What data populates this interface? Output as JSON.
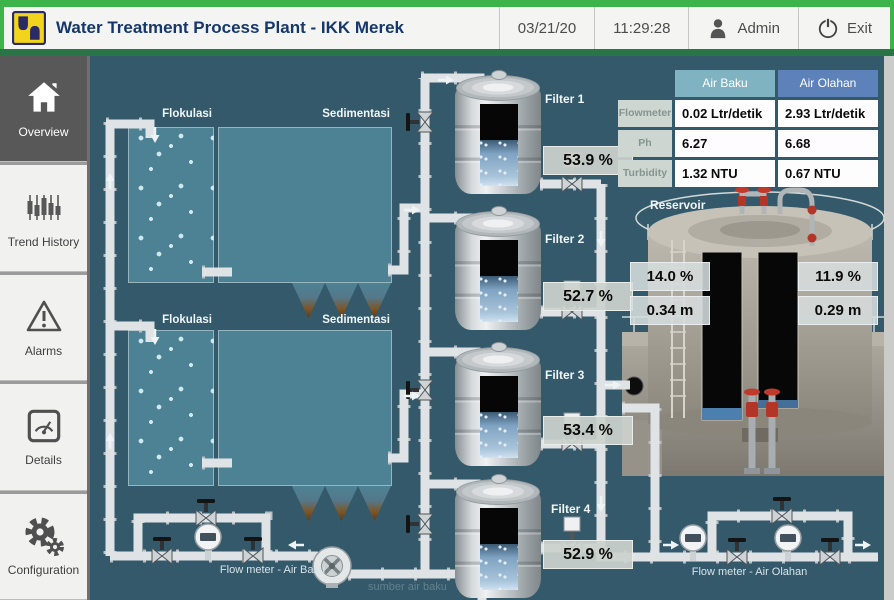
{
  "header": {
    "title": "Water Treatment Process Plant - IKK Merek",
    "date": "03/21/20",
    "time": "11:29:28",
    "user": "Admin",
    "exit_label": "Exit"
  },
  "sidebar": {
    "items": [
      {
        "label": "Overview",
        "active": true
      },
      {
        "label": "Trend History",
        "active": false
      },
      {
        "label": "Alarms",
        "active": false
      },
      {
        "label": "Details",
        "active": false
      },
      {
        "label": "Configuration",
        "active": false
      }
    ]
  },
  "process": {
    "trains": [
      {
        "flocculation_label": "Flokulasi",
        "sedimentation_label": "Sedimentasi"
      },
      {
        "flocculation_label": "Flokulasi",
        "sedimentation_label": "Sedimentasi"
      }
    ],
    "filters": [
      {
        "label": "Filter 1",
        "level": "53.9 %"
      },
      {
        "label": "Filter 2",
        "level": "52.7 %"
      },
      {
        "label": "Filter 3",
        "level": "53.4 %"
      },
      {
        "label": "Filter 4",
        "level": "52.9 %"
      }
    ],
    "reservoir": {
      "label": "Reservoir",
      "left": {
        "percent": "14.0 %",
        "level": "0.34 m"
      },
      "right": {
        "percent": "11.9 %",
        "level": "0.29 m"
      }
    },
    "flow_meter_raw_label": "Flow meter - Air Baku",
    "flow_meter_treated_label": "Flow meter - Air Olahan",
    "source_label": "sumber air baku"
  },
  "quality_table": {
    "columns": [
      "Air Baku",
      "Air Olahan"
    ],
    "rows": [
      {
        "label": "Flowmeter",
        "air_baku": "0.02 Ltr/detik",
        "air_olahan": "2.93 Ltr/detik"
      },
      {
        "label": "Ph",
        "air_baku": "6.27",
        "air_olahan": "6.68"
      },
      {
        "label": "Turbidity",
        "air_baku": "1.32 NTU",
        "air_olahan": "0.67 NTU"
      }
    ]
  },
  "colors": {
    "accent_green": "#3cb44a",
    "divider_green": "#2a7547",
    "title_navy": "#15376b",
    "main_background": "#33596b",
    "air_baku_header": "#7fb3c2",
    "air_olahan_header": "#5d81b9",
    "active_nav_background": "#585858",
    "valve_red": "#b23528"
  }
}
